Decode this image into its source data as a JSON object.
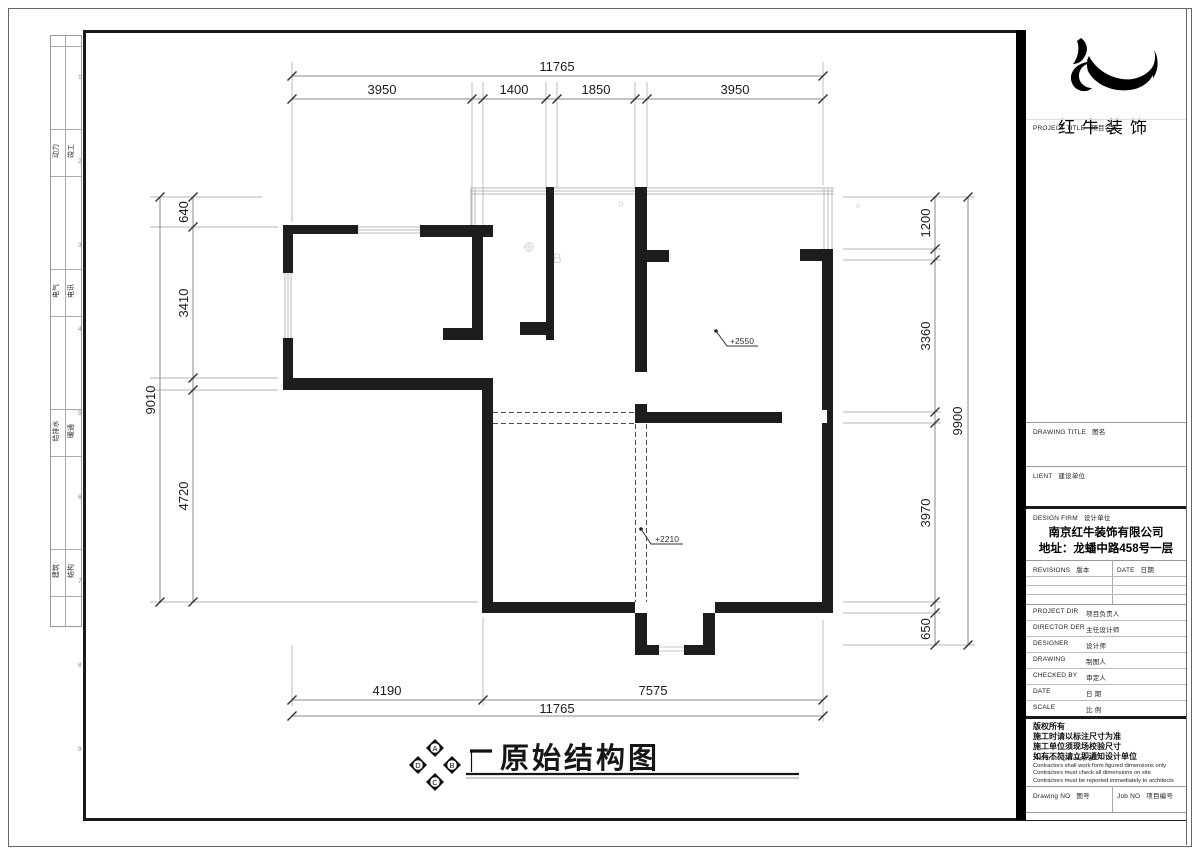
{
  "sheet": {
    "discipline_strip": [
      {
        "left": "动力",
        "right": "竣工"
      },
      {
        "left": "电气",
        "right": "电讯"
      },
      {
        "left": "给排水",
        "right": "暖通"
      },
      {
        "left": "建筑",
        "right": "结构"
      }
    ],
    "grid_refs": [
      "1",
      "2",
      "3",
      "4",
      "5",
      "6",
      "7",
      "8",
      "9"
    ]
  },
  "title_block": {
    "brand": "红牛装饰",
    "project_title_label": {
      "en": "PROJECT TITLE",
      "zh": "项目名称"
    },
    "drawing_title_label": {
      "en": "DRAWING TITLE",
      "zh": "图名"
    },
    "client_label": {
      "en": "LIENT",
      "zh": "建设单位"
    },
    "design_firm_label": {
      "en": "DESIGN FIRM",
      "zh": "设计单位"
    },
    "firm_name": "南京红牛装饰有限公司",
    "firm_address": "地址：龙蟠中路458号一层",
    "revisions_label": {
      "en": "REVISIONS",
      "zh": "版本"
    },
    "date_col_label": {
      "en": "DATE",
      "zh": "日期"
    },
    "staff_rows": [
      {
        "en": "PROJECT DIR",
        "zh": "项目负责人"
      },
      {
        "en": "DIRECTOR DER",
        "zh": "主任设计师"
      },
      {
        "en": "DESIGNER",
        "zh": "设计师"
      },
      {
        "en": "DRAWING",
        "zh": "制图人"
      },
      {
        "en": "CHECKED BY",
        "zh": "审定人"
      },
      {
        "en": "DATE",
        "zh": "日  期"
      },
      {
        "en": "SCALE",
        "zh": "比  例"
      }
    ],
    "copyright_zh": [
      "版权所有",
      "施工时请以标注尺寸为准",
      "施工单位须现场校验尺寸",
      "如有不符请立即通知设计单位"
    ],
    "copyright_en": [
      "This drawing is copyright",
      "Contractors shall work form figured dimensions only",
      "Contractors must check all dimensions on site",
      "Contractors must be reported immediately to architects"
    ],
    "drawing_no_label": {
      "en": "Drawing NO",
      "zh": "图号"
    },
    "job_no_label": {
      "en": "Job NO",
      "zh": "项目编号"
    }
  },
  "plan": {
    "title": "原始结构图",
    "compass": {
      "top": "A",
      "right": "B",
      "bottom": "C",
      "left": "D"
    },
    "levels": {
      "upper": "+2550",
      "lower": "+2210"
    },
    "artifact_letter": "B",
    "dims": {
      "top": {
        "total": "11765",
        "segments": [
          "3950",
          "1400",
          "1850",
          "3950"
        ]
      },
      "bottom": {
        "total": "11765",
        "segments": [
          "4190",
          "7575"
        ]
      },
      "left": {
        "total": "9010",
        "segments": [
          "640",
          "3410",
          "4720"
        ]
      },
      "right": {
        "total": "9900",
        "segments": [
          "1200",
          "3360",
          "3970",
          "650"
        ]
      }
    }
  }
}
